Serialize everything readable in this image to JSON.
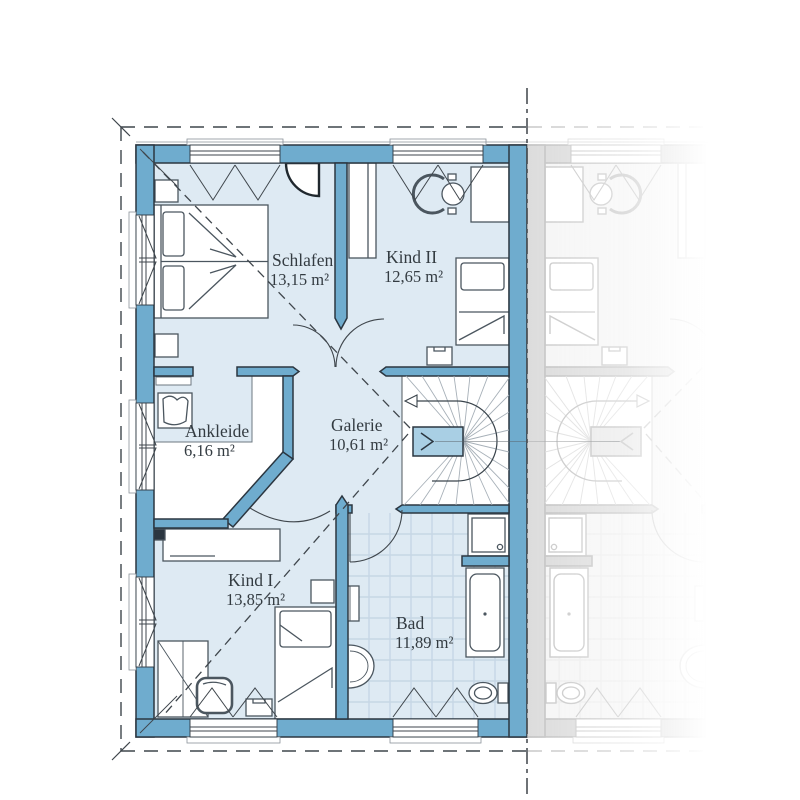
{
  "plan": {
    "title": "floor-plan-upper-storey",
    "rooms": [
      {
        "name": "Schlafen",
        "area": "13,15 m²"
      },
      {
        "name": "Kind II",
        "area": "12,65 m²"
      },
      {
        "name": "Ankleide",
        "area": "6,16 m²"
      },
      {
        "name": "Galerie",
        "area": "10,61 m²"
      },
      {
        "name": "Kind I",
        "area": "13,85 m²"
      },
      {
        "name": "Bad",
        "area": "11,89 m²"
      }
    ],
    "colors": {
      "wall": "#6FACCE",
      "floor": "#DEEAF3",
      "stair_landing": "#A9CFE4",
      "outline": "#2B3640",
      "furniture_line": "#4B565F",
      "dashed_line": "#3F464C",
      "text": "#333B41"
    },
    "icons": [
      {
        "id": "stair-direction-arrow",
        "meaning": "stair walk-line arrow pointing to descent"
      },
      {
        "id": "landing-chevron",
        "meaning": "knee-wall height marker chevron"
      },
      {
        "id": "mirror-axis",
        "meaning": "party wall / mirror axis dash-dot line"
      }
    ]
  }
}
